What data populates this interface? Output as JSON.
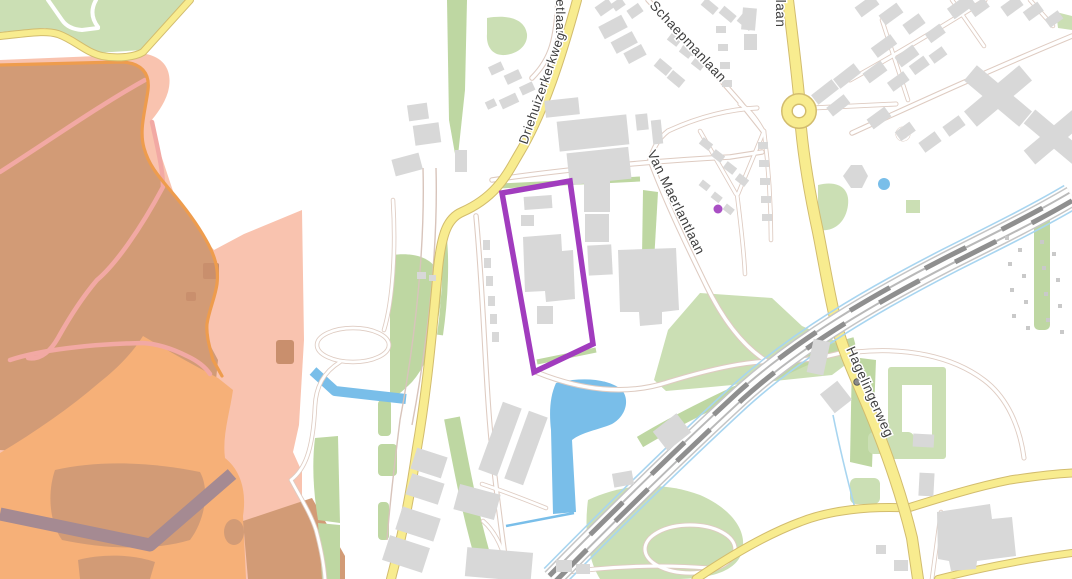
{
  "map": {
    "kind": "street-map-with-parcel-selection",
    "labels": [
      {
        "id": "stetlaan-partial",
        "text": "stetlaan"
      },
      {
        "id": "driehuizerkerkweg",
        "text": "Driehuizerkerkweg"
      },
      {
        "id": "schaepmanlaan",
        "text": "Schaepmanlaan"
      },
      {
        "id": "laan-partial",
        "text": "llaan"
      },
      {
        "id": "van-maerlantlaan",
        "text": "Van Maerlantlaan"
      },
      {
        "id": "hagelingerweg",
        "text": "Hagelingerweg"
      }
    ],
    "selection": {
      "type": "parcel-outline",
      "stroke_color": "#a13cbe"
    },
    "poi_marker": {
      "type": "dot",
      "color": "#a94fc4"
    },
    "palette": {
      "background": "#ffffff",
      "heath_tan": "#d29b76",
      "heath_orange": "#f6b078",
      "heath_pink": "#f9c3af",
      "boundary_orange": "#ee9c4d",
      "dyke_mauve": "#a58a92",
      "green": "#cbdfb4",
      "green_dark": "#bed7a2",
      "water": "#79bee9",
      "road_yellow": "#f8ec8f",
      "building_gray": "#d8d8d8",
      "selection_purple": "#a13cbe"
    }
  }
}
